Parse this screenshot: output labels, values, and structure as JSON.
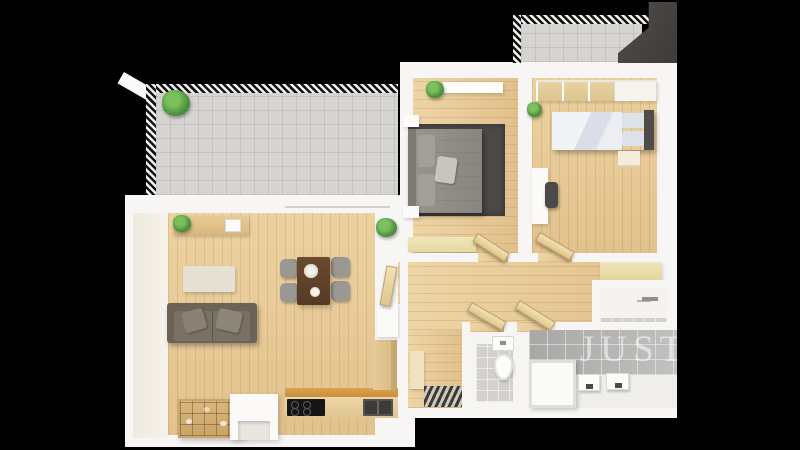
{
  "watermark": {
    "text": "JUSTO"
  },
  "scene": {
    "type": "3d-floor-plan-top-view-render",
    "background": "black",
    "rooms": [
      {
        "name": "terrace",
        "items": [
          "tiled-floor",
          "striped-railing",
          "plant",
          "sliding-glass-door"
        ]
      },
      {
        "name": "living-room-kitchen",
        "items": [
          "sideboard",
          "plant",
          "plant",
          "beige-rug",
          "dining-table",
          "chair",
          "chair",
          "chair",
          "chair",
          "sofa",
          "pillows",
          "compartment-shelf",
          "kitchen-island",
          "cooktop",
          "kitchen-sink",
          "tall-cabinet",
          "white-counter",
          "open-door"
        ]
      },
      {
        "name": "bedroom-1",
        "items": [
          "double-bed",
          "dark-rug",
          "nightstand",
          "nightstand",
          "wall-shelf",
          "bench",
          "plant",
          "open-door"
        ]
      },
      {
        "name": "bedroom-2",
        "items": [
          "wardrobe",
          "single-bed",
          "headboard",
          "nightstand",
          "desk",
          "chair",
          "plant",
          "open-door"
        ]
      },
      {
        "name": "hallway",
        "items": [
          "striped-doormat",
          "shoe-cabinet",
          "bench",
          "open-door",
          "open-door"
        ]
      },
      {
        "name": "wc",
        "items": [
          "toilet",
          "cistern",
          "tiled-floor"
        ]
      },
      {
        "name": "bathroom",
        "items": [
          "bathtub",
          "sink",
          "sink",
          "tiled-wall"
        ]
      },
      {
        "name": "utility-room",
        "items": [
          "faucet",
          "tiled-floor"
        ]
      },
      {
        "name": "balcony",
        "items": [
          "tiled-floor",
          "striped-railing",
          "dark-privacy-wall"
        ]
      }
    ]
  },
  "colors": {
    "bg": "#000000",
    "wall": "#f7f6f4",
    "tile": "#d6d4d1",
    "dark-wall": "#454240",
    "sofa-body": "#6b6357",
    "sofa-seat": "#7a7165",
    "rug-living": "#e6e0d3",
    "rug-bedroom": "#4b4a48",
    "table": "#5d4029",
    "chair": "#9b9893",
    "bed-gray": "#8f8b85",
    "duvet": "#e9ebf0",
    "headboard": "#4e4b48",
    "bench": "#ece1af",
    "tan-strip": "#d3953f",
    "wm": "rgba(255,255,255,0.55)"
  }
}
